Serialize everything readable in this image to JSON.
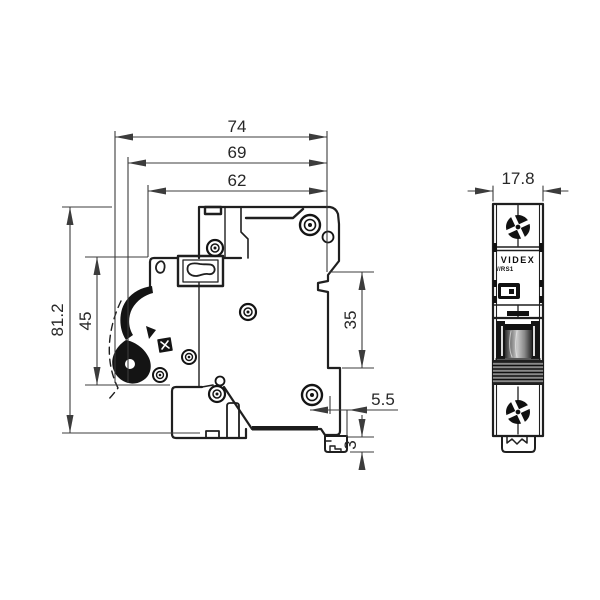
{
  "drawing": {
    "front_view": {
      "brand": "VIDEX",
      "model": "//RS1"
    },
    "dimensions": {
      "top": [
        "74",
        "69",
        "62"
      ],
      "left": [
        "81.2",
        "45"
      ],
      "right": [
        "35",
        "5.5",
        "3"
      ],
      "front": [
        "17.8"
      ]
    },
    "colors": {
      "line": "#1f1f1f",
      "dim_line": "#3c3c3c",
      "label": "#272727",
      "fill_dark": "#141414"
    }
  }
}
